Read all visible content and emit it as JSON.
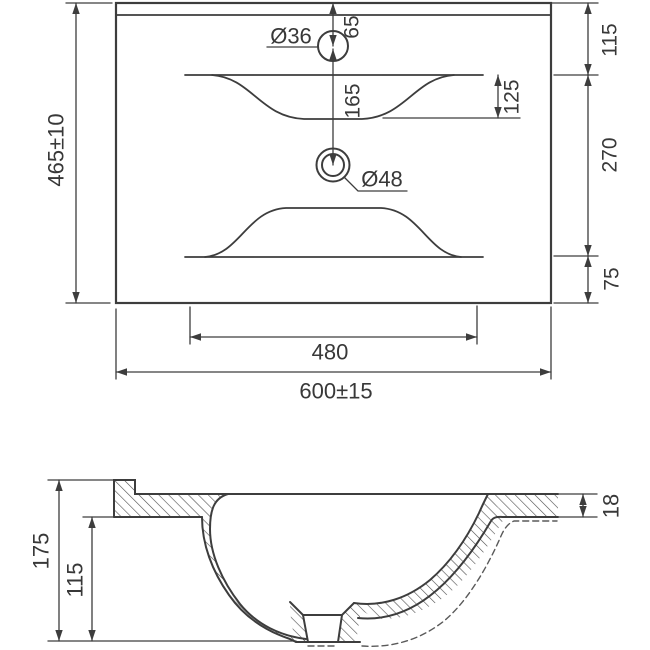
{
  "drawing_title": "washbasin-dimensional-drawing",
  "colors": {
    "ink": "#3d3d3d",
    "dim_line": "#4a4a4a",
    "text": "#383838",
    "background": "#ffffff"
  },
  "top_view": {
    "overall_width": "600±15",
    "overall_depth": "465±10",
    "fixing_hole_centers": "480",
    "faucet_hole_diameter": "Ø36",
    "drain_hole_diameter": "Ø48",
    "faucet_hole_offset": "65",
    "drain_hole_offset": "165",
    "basin_recess_depth": "125",
    "back_edge_to_basin": "115",
    "basin_opening_depth": "270",
    "basin_to_front_edge": "75"
  },
  "section_view": {
    "overall_height": "175",
    "bowl_inner_depth": "115",
    "front_rim_thickness": "18"
  }
}
